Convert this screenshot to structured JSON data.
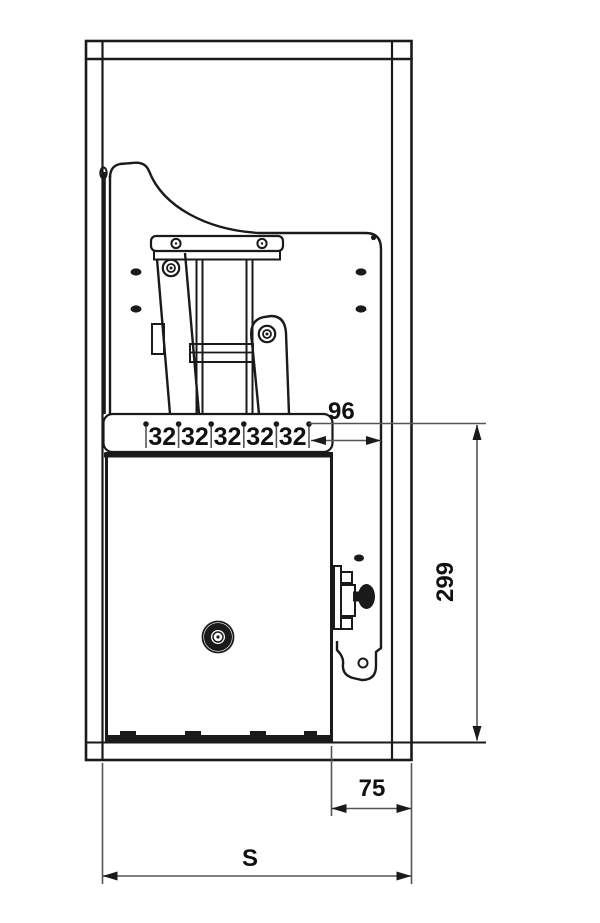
{
  "drawing": {
    "title": "cabinet pull-out mechanism installation drawing",
    "dimensions": {
      "spacing_labels": [
        "32",
        "32",
        "32",
        "32",
        "32"
      ],
      "offset_right": "96",
      "height_right": "299",
      "bottom_offset": "75",
      "overall_width": "S"
    },
    "colors": {
      "line": "#1a1a1a",
      "background": "#ffffff",
      "text": "#111111"
    }
  }
}
